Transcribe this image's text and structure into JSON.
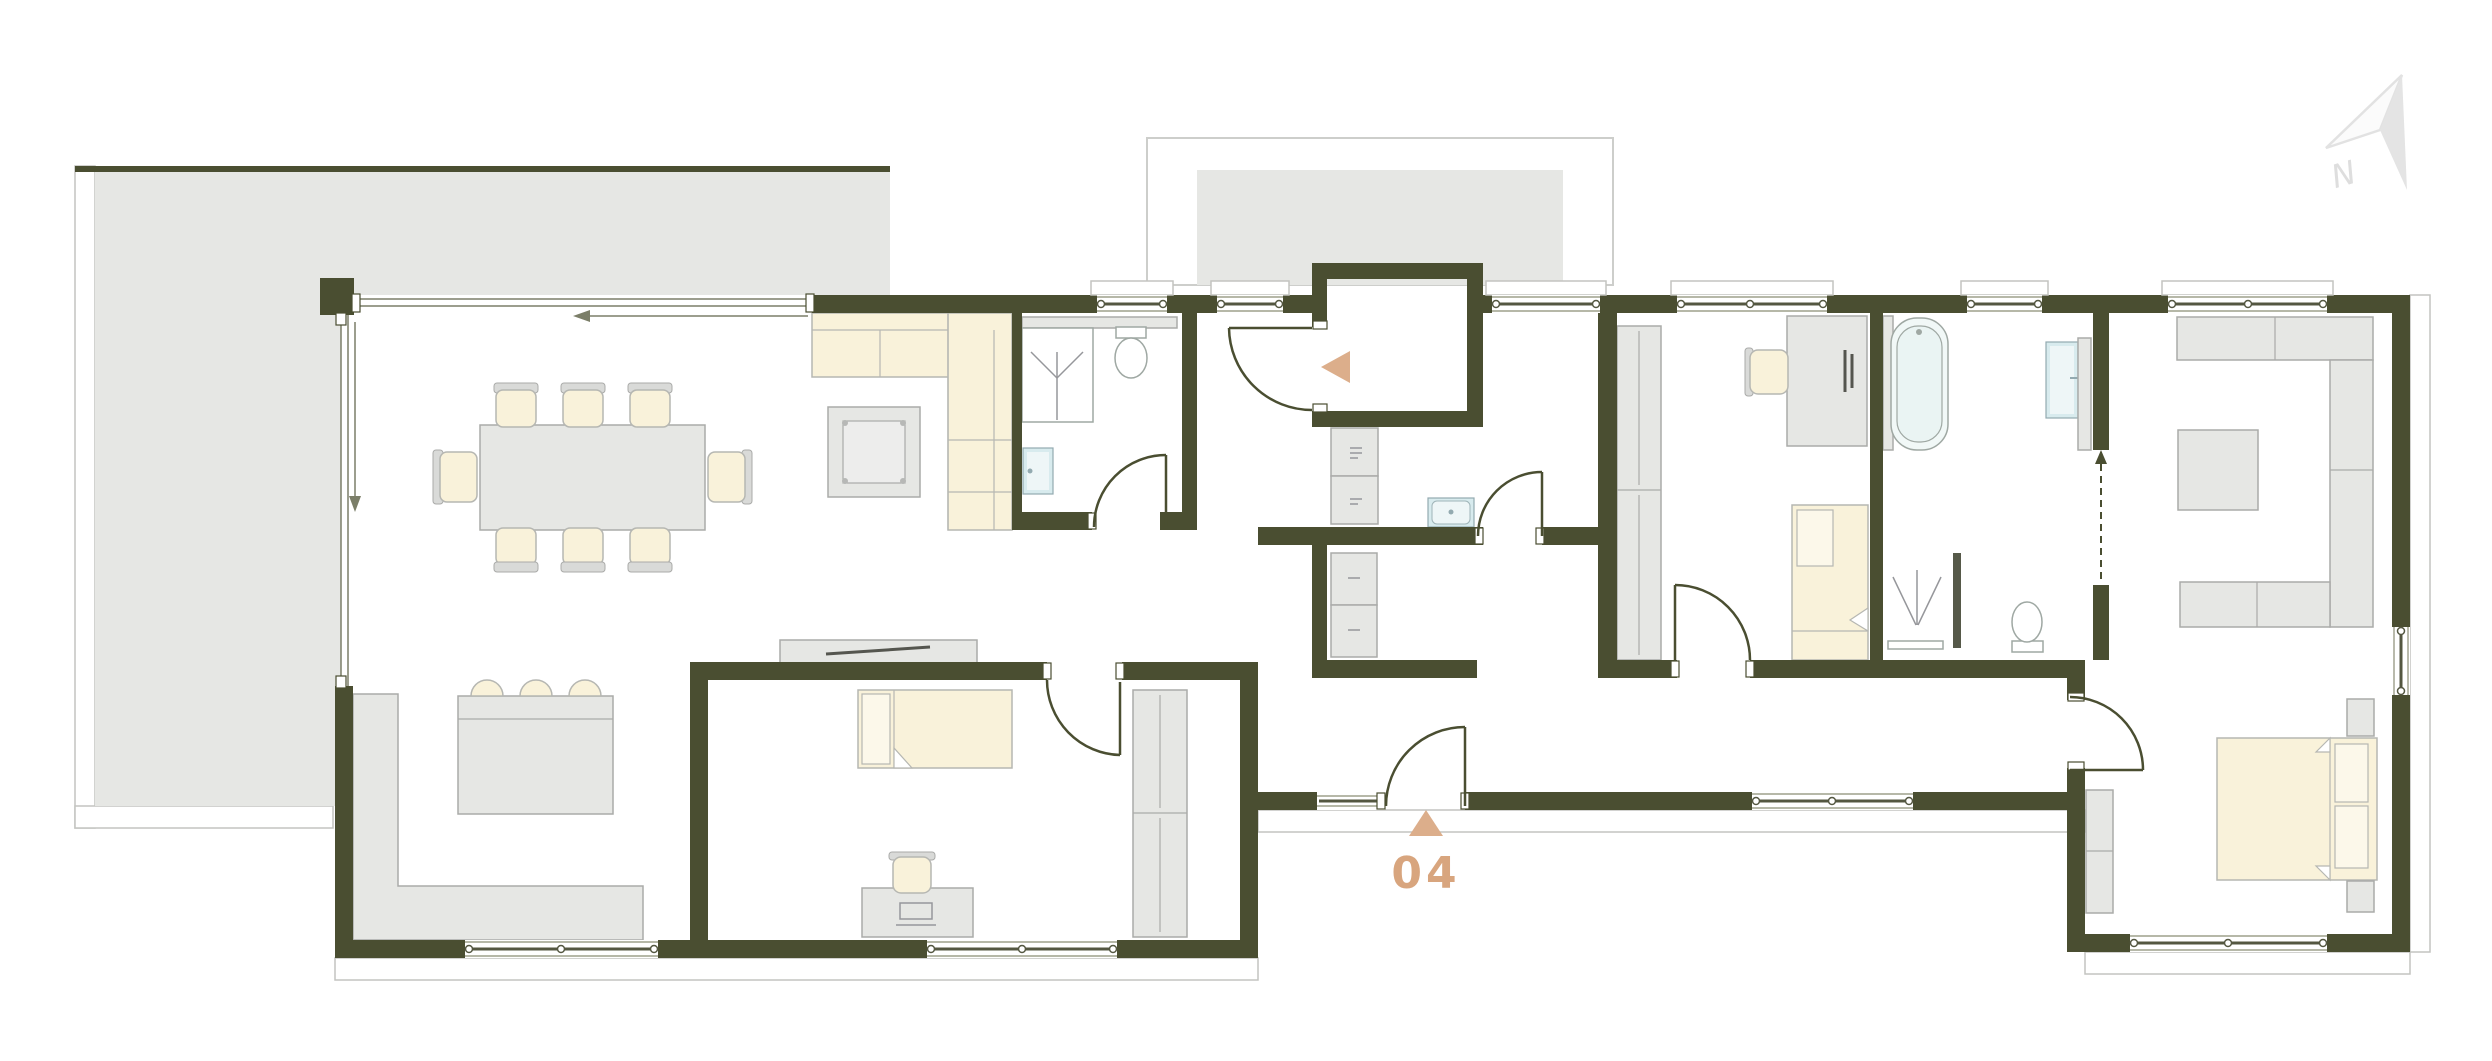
{
  "document": {
    "type": "architectural-floor-plan"
  },
  "unit": {
    "number": "04"
  },
  "compass": {
    "label": "N"
  },
  "palette": {
    "wall": "#4a4e31",
    "accent_text": "#d8a57e",
    "accent_triangle": "#dcae8b",
    "furniture_gray": "#e6e7e4",
    "furniture_stroke": "#aaaba9",
    "cream_upholstery": "#f9f2da",
    "terrace_gray": "#e6e7e4",
    "fixture_blue": "#d8ebee",
    "north_arrow_gray": "#e4e4e4",
    "outline_gray": "#c3c4c0"
  },
  "markers": {
    "entrance_marker": "triangle-up-icon",
    "vestibule_marker": "triangle-left-icon",
    "north_marker": "north-arrow-icon"
  },
  "rooms": [
    {
      "name": "terrace"
    },
    {
      "name": "porch"
    },
    {
      "name": "living-dining-kitchen"
    },
    {
      "name": "shower-room"
    },
    {
      "name": "entrance-vestibule"
    },
    {
      "name": "hall-utility"
    },
    {
      "name": "pantry"
    },
    {
      "name": "corridor"
    },
    {
      "name": "bedroom-middle"
    },
    {
      "name": "bedroom-study"
    },
    {
      "name": "bathroom"
    },
    {
      "name": "master-bedroom-suite"
    }
  ],
  "furniture": [
    "dining-table",
    "dining-chair",
    "corner-sofa",
    "coffee-table",
    "kitchen-counter",
    "kitchen-island",
    "bar-stool",
    "tv-sideboard",
    "single-bed",
    "desk",
    "desk-chair",
    "wardrobe",
    "washer",
    "dryer",
    "utility-sink",
    "cabinet",
    "bathtub",
    "shower",
    "toilet",
    "washbasin",
    "double-bed",
    "nightstand",
    "ottoman"
  ]
}
